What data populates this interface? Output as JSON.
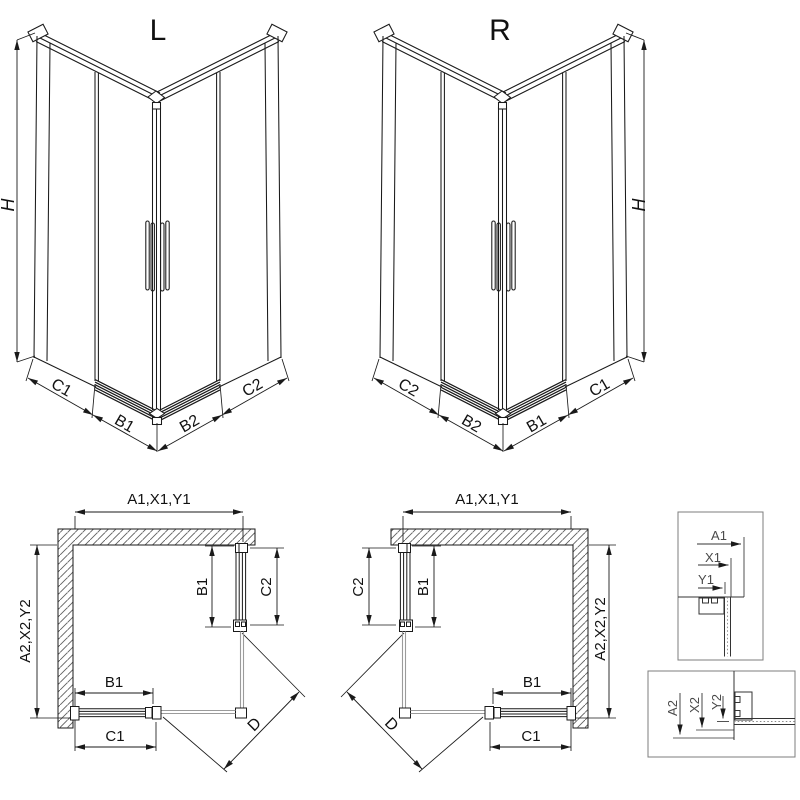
{
  "drawing": {
    "iso_left": {
      "title": "L",
      "height_dim": "H",
      "bottom_dims": [
        "C1",
        "B1",
        "B2",
        "C2"
      ]
    },
    "iso_right": {
      "title": "R",
      "height_dim": "H",
      "bottom_dims": [
        "C2",
        "B2",
        "B1",
        "C1"
      ]
    },
    "plan_left": {
      "top_dim": "A1,X1,Y1",
      "side_dim": "A2,X2,Y2",
      "door_side_inner_dim": "B1",
      "door_side_outer_dim": "C2",
      "door_front_inner_dim": "B1",
      "door_front_outer_dim": "C1",
      "diagonal_dim": "D"
    },
    "plan_right": {
      "top_dim": "A1,X1,Y1",
      "side_dim": "A2,X2,Y2",
      "door_side_inner_dim": "B1",
      "door_side_outer_dim": "C2",
      "door_front_inner_dim": "B1",
      "door_front_outer_dim": "C1",
      "diagonal_dim": "D"
    },
    "detail_width": {
      "dims": [
        "A1",
        "X1",
        "Y1"
      ]
    },
    "detail_depth": {
      "dims": [
        "A2",
        "X2",
        "Y2"
      ]
    }
  },
  "colors": {
    "line": "#1a1a1a",
    "glass": "#9b9b9b",
    "hatch": "#5f5f5f",
    "box_border": "#7d7d7d",
    "detail_text": "#4a4a4a",
    "background": "#ffffff"
  }
}
